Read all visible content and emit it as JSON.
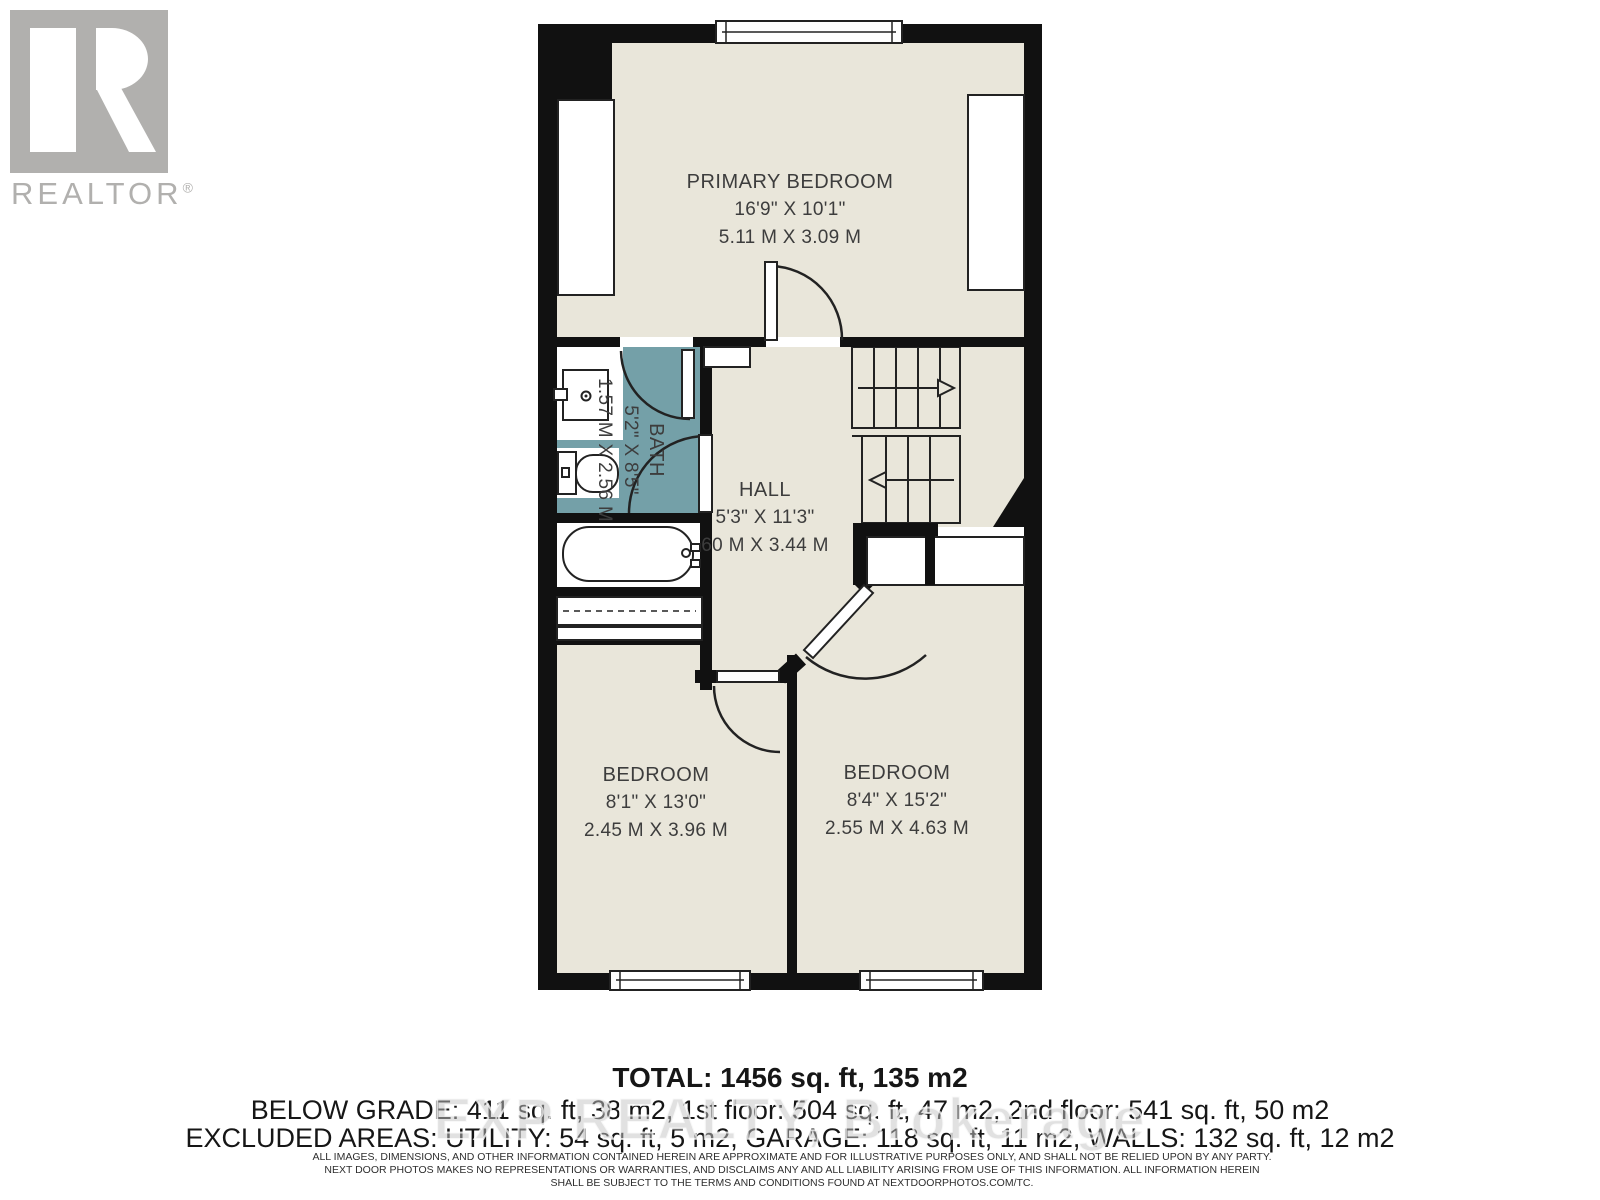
{
  "branding": {
    "logo_label": "REALTOR",
    "registered": "®"
  },
  "rooms": {
    "primary_bedroom": {
      "name": "PRIMARY BEDROOM",
      "imperial": "16'9\" X 10'1\"",
      "metric": "5.11 M X 3.09 M"
    },
    "bath": {
      "name": "BATH",
      "imperial": "5'2\" X 8'5\"",
      "metric": "1.57 M X 2.56 M"
    },
    "hall": {
      "name": "HALL",
      "imperial": "5'3\" X 11'3\"",
      "metric": "60 M X 3.44 M"
    },
    "bedroom_left": {
      "name": "BEDROOM",
      "imperial": "8'1\" X 13'0\"",
      "metric": "2.45 M X 3.96 M"
    },
    "bedroom_right": {
      "name": "BEDROOM",
      "imperial": "8'4\" X 15'2\"",
      "metric": "2.55 M X 4.63 M"
    }
  },
  "summary": {
    "total": "TOTAL: 1456 sq. ft, 135 m2",
    "grade_line": "BELOW GRADE: 411 sq. ft, 38 m2, 1st floor: 504 sq. ft, 47 m2, 2nd floor: 541 sq. ft, 50 m2",
    "excluded_line": "EXCLUDED AREAS: UTILITY: 54 sq. ft, 5 m2, GARAGE: 118 sq. ft, 11 m2, WALLS: 132 sq. ft, 12 m2"
  },
  "watermark": "EXP REALTY, Brokerage",
  "disclaimer": {
    "line1": "ALL IMAGES, DIMENSIONS, AND OTHER INFORMATION CONTAINED HEREIN ARE APPROXIMATE AND FOR ILLUSTRATIVE PURPOSES ONLY, AND SHALL NOT BE RELIED UPON BY ANY PARTY.",
    "line2": "NEXT DOOR PHOTOS MAKES NO REPRESENTATIONS OR WARRANTIES, AND DISCLAIMS ANY AND ALL LIABILITY ARISING FROM USE OF THIS INFORMATION. ALL INFORMATION HEREIN",
    "line3": "SHALL BE SUBJECT TO THE TERMS AND CONDITIONS FOUND AT NEXTDOORPHOTOS.COM/TC."
  },
  "colors": {
    "floor": "#e9e6da",
    "wall": "#111111",
    "bath_highlight": "#74a0a8",
    "logo_gray": "#b1b0ae"
  }
}
